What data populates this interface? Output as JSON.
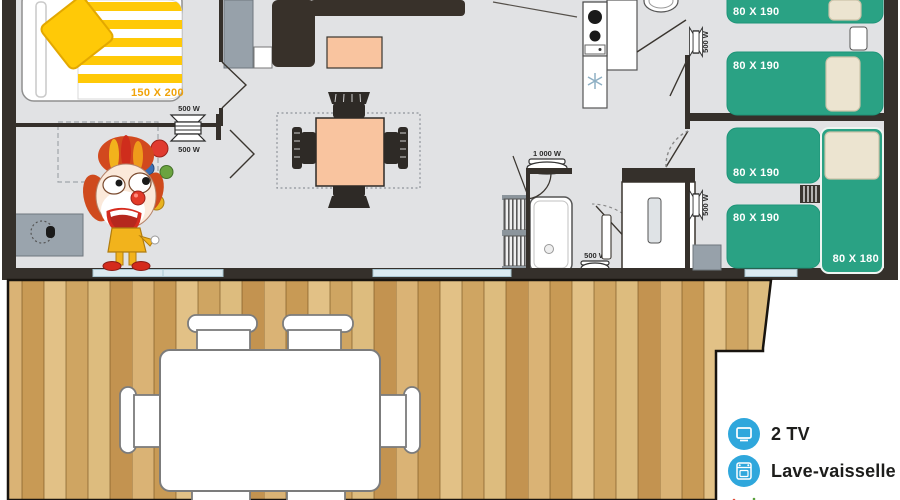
{
  "plan": {
    "bed_labels": {
      "master": "150 X 200",
      "single": "80 X 190",
      "corner": "80 X 180"
    },
    "heaters": {
      "small": "500 W",
      "large": "1 000 W"
    }
  },
  "legend": {
    "items": [
      {
        "icon": "tv-icon",
        "label": "2 TV"
      },
      {
        "icon": "dishwasher-icon",
        "label": "Lave-vaisselle"
      },
      {
        "icon": "clown-icon",
        "label": "Club enfant"
      }
    ]
  },
  "colors": {
    "bed_green": "#2aa284",
    "blanket_yellow": "#ffc907",
    "salmon": "#f9c49f",
    "wall_dark": "#35302b",
    "floor_gray": "#e1e2e4",
    "legend_blue": "#2fa7dc",
    "wood": "#d6ad6c",
    "size_label_orange": "#f0a30a"
  }
}
